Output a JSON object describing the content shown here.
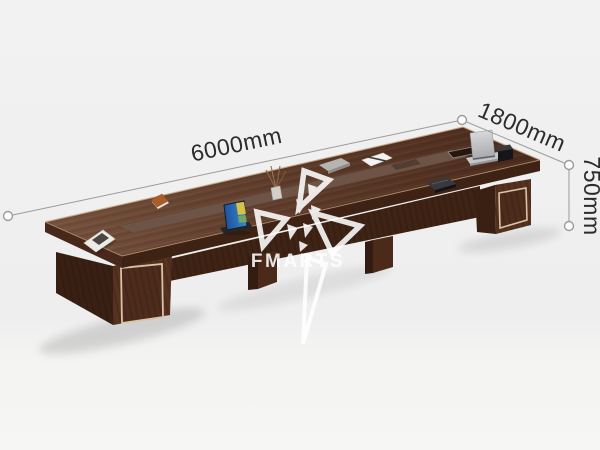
{
  "image": {
    "width": 600,
    "height": 450,
    "subject": "3D product render of a long dark-walnut conference table with dimension callouts"
  },
  "dimension_labels": {
    "length": "6000mm",
    "depth": "1800mm",
    "height": "750mm"
  },
  "watermark": {
    "brand": "FMARTS"
  },
  "table": {
    "items_on_surface": [
      "magazine",
      "orange-notebook",
      "mini-laptop",
      "reed-diffuser",
      "gray-tray",
      "notepad-with-pen",
      "dark-book",
      "silver-laptop",
      "power-module",
      "cable-port"
    ]
  },
  "colors": {
    "background": "#f2f2f3",
    "table_top": "#5e3c2b",
    "table_runner": "#6e5347",
    "table_edge": "#3e2314",
    "leg_front": "#563220",
    "leg_side": "#3a2013",
    "spine": "#3f2315",
    "trim": "#d9c2a6",
    "dimension_line": "#9b9b9b",
    "dimension_text": "#2c2c2c",
    "watermark": "#ffffff"
  }
}
